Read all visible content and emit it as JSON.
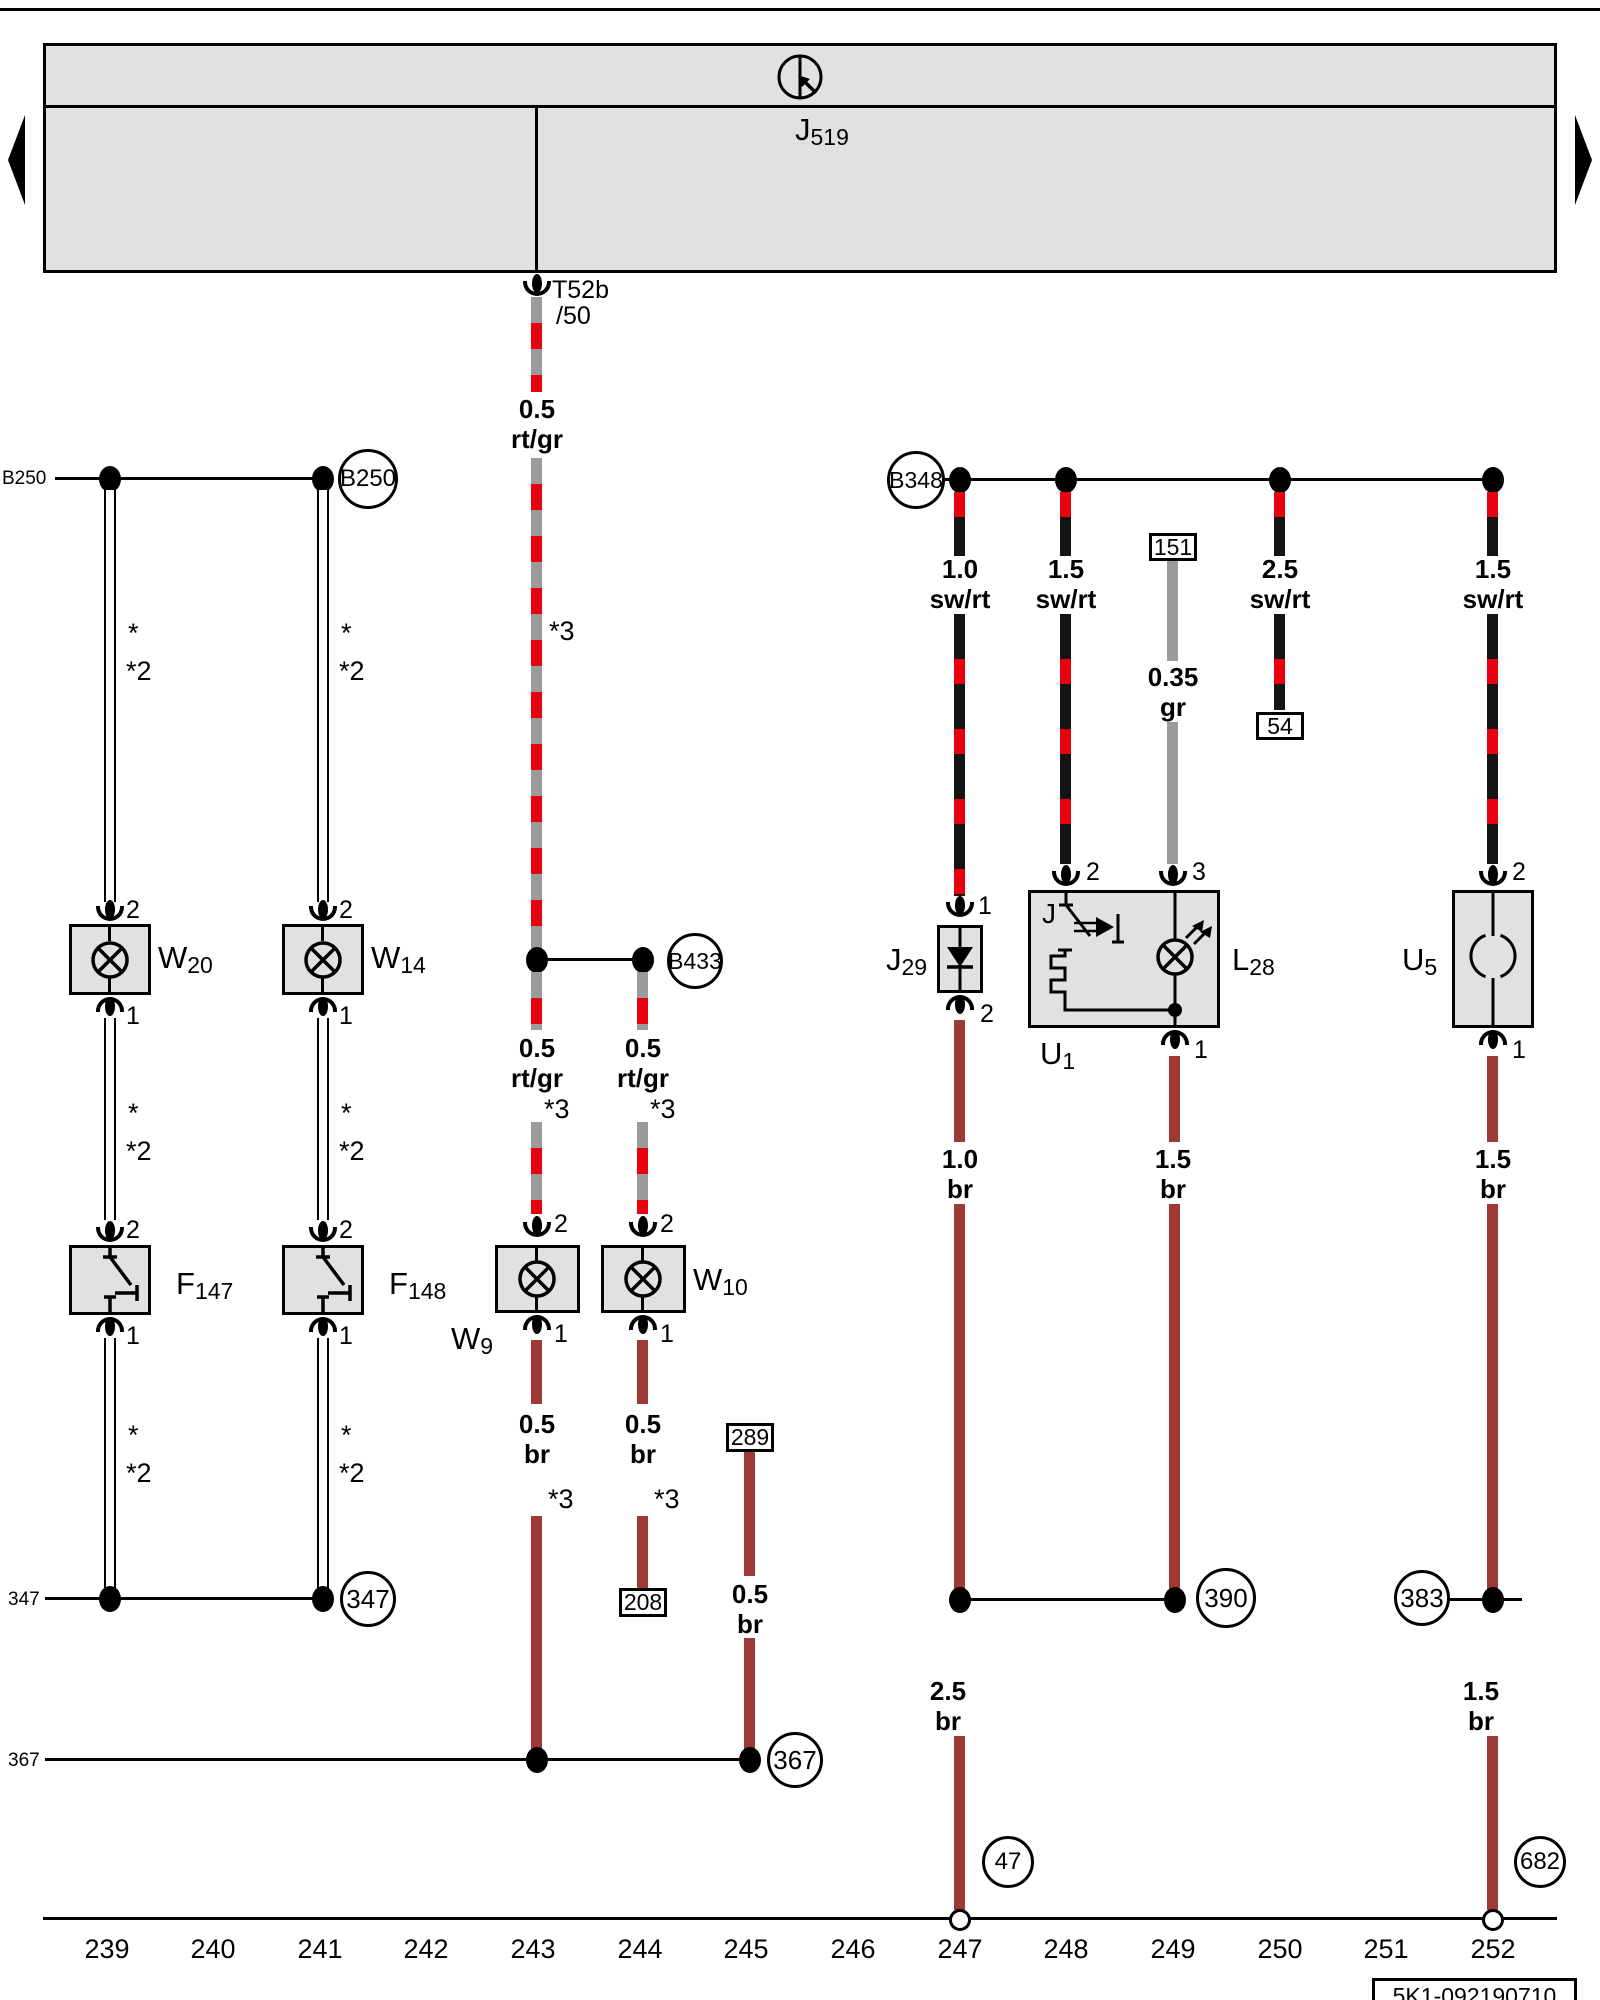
{
  "diagram": {
    "control_module": {
      "p": "J",
      "s": "519"
    },
    "connector": {
      "name": "T52b",
      "pin": "/50"
    },
    "part_number": "5K1-092190710"
  },
  "margin": {
    "b250": "B250",
    "n347": "347",
    "n367": "367"
  },
  "nodes": {
    "b250": "B250",
    "b433": "B433",
    "b348": "B348",
    "n347": "347",
    "n367": "367",
    "n390": "390",
    "n383": "383",
    "n47": "47",
    "n682": "682"
  },
  "refs": {
    "r151": "151",
    "r54": "54",
    "r289": "289",
    "r208": "208"
  },
  "components": {
    "w20": {
      "p": "W",
      "s": "20"
    },
    "w14": {
      "p": "W",
      "s": "14"
    },
    "f147": {
      "p": "F",
      "s": "147"
    },
    "f148": {
      "p": "F",
      "s": "148"
    },
    "w9": {
      "p": "W",
      "s": "9"
    },
    "w10": {
      "p": "W",
      "s": "10"
    },
    "j29": {
      "p": "J",
      "s": "29"
    },
    "u1": {
      "p": "U",
      "s": "1"
    },
    "l28": {
      "p": "L",
      "s": "28"
    },
    "u5": {
      "p": "U",
      "s": "5"
    }
  },
  "pins": {
    "p1": "1",
    "p2": "2",
    "p3": "3",
    "j": "J"
  },
  "marks": {
    "star": "*",
    "star2": "*2",
    "star3": "*3"
  },
  "wire_labels": {
    "t243_top": {
      "size": "0.5",
      "color": "rt/gr"
    },
    "t243_mid": {
      "size": "0.5",
      "color": "rt/gr"
    },
    "t244_mid": {
      "size": "0.5",
      "color": "rt/gr"
    },
    "t243_low": {
      "size": "0.5",
      "color": "br"
    },
    "t244_low": {
      "size": "0.5",
      "color": "br"
    },
    "t245": {
      "size": "0.5",
      "color": "br"
    },
    "t247_top": {
      "size": "1.0",
      "color": "sw/rt"
    },
    "t248_top": {
      "size": "1.5",
      "color": "sw/rt"
    },
    "t249_top": {
      "size": "0.35",
      "color": "gr"
    },
    "t250_top": {
      "size": "2.5",
      "color": "sw/rt"
    },
    "t252_top": {
      "size": "1.5",
      "color": "sw/rt"
    },
    "t247_mid": {
      "size": "1.0",
      "color": "br"
    },
    "t249_mid": {
      "size": "1.5",
      "color": "br"
    },
    "t252_mid": {
      "size": "1.5",
      "color": "br"
    },
    "t247_low": {
      "size": "2.5",
      "color": "br"
    },
    "t252_low": {
      "size": "1.5",
      "color": "br"
    }
  },
  "tracks": [
    "239",
    "240",
    "241",
    "242",
    "243",
    "244",
    "245",
    "246",
    "247",
    "250",
    "249",
    "250",
    "251",
    "252"
  ],
  "track_list": [
    "239",
    "240",
    "241",
    "242",
    "243",
    "244",
    "245",
    "246",
    "247",
    "248",
    "249",
    "250",
    "251",
    "252"
  ],
  "colors": {
    "red": "#e8000e",
    "gray_wire": "#9b9b9b",
    "brown": "#9e3a36",
    "box_fill": "#e1e1e1"
  }
}
